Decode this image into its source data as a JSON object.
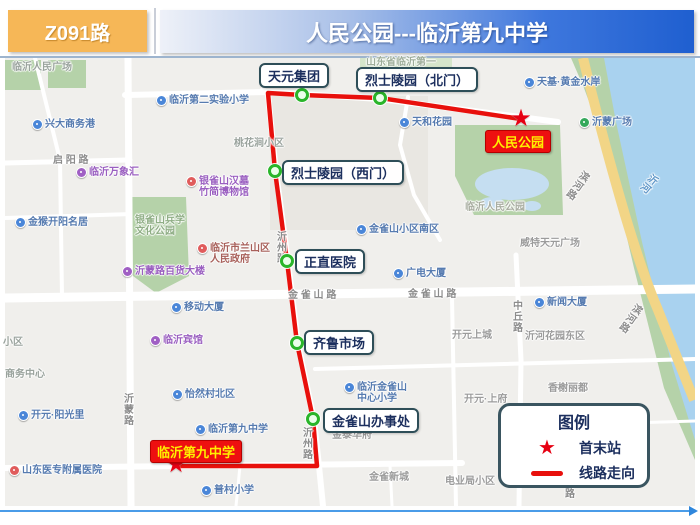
{
  "header": {
    "route_number": "Z091路",
    "route_title": "人民公园---临沂第九中学"
  },
  "legend": {
    "title": "图例",
    "items": [
      {
        "symbol": "star",
        "label": "首末站"
      },
      {
        "symbol": "route-line",
        "label": "线路走向"
      }
    ]
  },
  "route": {
    "color": "#e8100c",
    "path": "521,119 380,98 302,95 268,93 275,171 287,261 297,343 313,419 317,466 176,466",
    "terminals": [
      {
        "label": "人民公园",
        "box_x": 485,
        "box_y": 130,
        "star_x": 521,
        "star_y": 120
      },
      {
        "label": "临沂第九中学",
        "box_x": 150,
        "box_y": 440,
        "star_x": 176,
        "star_y": 466
      }
    ],
    "stops": [
      {
        "label": "天元集团",
        "box_x": 259,
        "box_y": 63,
        "dot_x": 302,
        "dot_y": 95
      },
      {
        "label": "烈士陵园（北门）",
        "box_x": 356,
        "box_y": 67,
        "dot_x": 380,
        "dot_y": 98
      },
      {
        "label": "烈士陵园（西门）",
        "box_x": 282,
        "box_y": 160,
        "dot_x": 275,
        "dot_y": 171
      },
      {
        "label": "正直医院",
        "box_x": 295,
        "box_y": 249,
        "dot_x": 287,
        "dot_y": 261
      },
      {
        "label": "齐鲁市场",
        "box_x": 304,
        "box_y": 330,
        "dot_x": 297,
        "dot_y": 343
      },
      {
        "label": "金雀山办事处",
        "box_x": 323,
        "box_y": 408,
        "dot_x": 313,
        "dot_y": 419
      }
    ]
  },
  "map": {
    "labels": [
      {
        "text": "临沂人民广场",
        "x": 12,
        "y": 62,
        "color": "#9aa39d"
      },
      {
        "pin": "#4a86d8",
        "text": "兴大商务港",
        "x": 32,
        "y": 119,
        "color": "#567bb0"
      },
      {
        "text": "启 阳 路",
        "x": 53,
        "y": 155,
        "color": "#8c8c8c"
      },
      {
        "pin": "#a05fc4",
        "text": "临沂万象汇",
        "x": 76,
        "y": 167,
        "color": "#9a5fc0"
      },
      {
        "pin": "#4a86d8",
        "text": "金猴开阳名居",
        "x": 15,
        "y": 217,
        "color": "#567bb0"
      },
      {
        "pin": "#e05c5c",
        "lines": [
          "银雀山汉墓",
          "竹简博物馆"
        ],
        "x": 186,
        "y": 176,
        "color": "#9a5fc0"
      },
      {
        "lines": [
          "银雀山兵学",
          "文化公园"
        ],
        "x": 135,
        "y": 215,
        "color": "#8fae85"
      },
      {
        "pin": "#e05c5c",
        "lines": [
          "临沂市兰山区",
          "人民政府"
        ],
        "x": 197,
        "y": 243,
        "color": "#a8605a"
      },
      {
        "pin": "#a05fc4",
        "text": "沂蒙路百货大楼",
        "x": 122,
        "y": 266,
        "color": "#9a5fc0"
      },
      {
        "pin": "#4a86d8",
        "text": "移动大厦",
        "x": 171,
        "y": 302,
        "color": "#567bb0"
      },
      {
        "pin": "#a05fc4",
        "text": "临沂宾馆",
        "x": 150,
        "y": 335,
        "color": "#9a5fc0"
      },
      {
        "text": "小区",
        "x": 3,
        "y": 337,
        "color": "#9aa39d"
      },
      {
        "text": "商务中心",
        "x": 5,
        "y": 369,
        "color": "#9aa39d"
      },
      {
        "pin": "#4a86d8",
        "text": "开元·阳光里",
        "x": 18,
        "y": 410,
        "color": "#567bb0"
      },
      {
        "text": "沂蒙路",
        "x": 124,
        "y": 394,
        "color": "#8c8c8c",
        "vertical": true
      },
      {
        "pin": "#e05c5c",
        "text": "山东医专附属医院",
        "x": 9,
        "y": 465,
        "color": "#567bb0"
      },
      {
        "pin": "#4a86d8",
        "text": "怡然村北区",
        "x": 172,
        "y": 389,
        "color": "#567bb0"
      },
      {
        "pin": "#4a86d8",
        "text": "临沂第九中学",
        "x": 195,
        "y": 424,
        "color": "#567bb0"
      },
      {
        "pin": "#4a86d8",
        "text": "普村小学",
        "x": 201,
        "y": 485,
        "color": "#567bb0"
      },
      {
        "pin": "#4a86d8",
        "text": "临沂第二实验小学",
        "x": 156,
        "y": 95,
        "color": "#567bb0"
      },
      {
        "text": "桃花涧小区",
        "x": 234,
        "y": 138,
        "color": "#9aa39d"
      },
      {
        "text": "山东省临沂第一",
        "x": 366,
        "y": 57,
        "color": "#9fae9a"
      },
      {
        "pin": "#4a86d8",
        "text": "天和花园",
        "x": 399,
        "y": 117,
        "color": "#567bb0"
      },
      {
        "pin": "#4a86d8",
        "text": "金雀山小区南区",
        "x": 356,
        "y": 224,
        "color": "#567bb0"
      },
      {
        "pin": "#4a86d8",
        "text": "广电大厦",
        "x": 393,
        "y": 268,
        "color": "#567bb0"
      },
      {
        "text": "金 雀 山 路",
        "x": 288,
        "y": 290,
        "color": "#8c8c8c"
      },
      {
        "text": "金 雀 山 路",
        "x": 408,
        "y": 289,
        "color": "#8c8c8c"
      },
      {
        "text": "沂州路",
        "x": 277,
        "y": 232,
        "color": "#8c8c8c",
        "vertical": true
      },
      {
        "text": "沂州路",
        "x": 303,
        "y": 428,
        "color": "#8c8c8c",
        "vertical": true
      },
      {
        "text": "开元上城",
        "x": 452,
        "y": 330,
        "color": "#9b9b9b"
      },
      {
        "text": "威特天元广场",
        "x": 520,
        "y": 238,
        "color": "#9b9b9b"
      },
      {
        "pin": "#4a86d8",
        "text": "新闻大厦",
        "x": 534,
        "y": 297,
        "color": "#567bb0"
      },
      {
        "text": "中丘路",
        "x": 513,
        "y": 301,
        "color": "#8c8c8c",
        "vertical": true
      },
      {
        "text": "沂河花园东区",
        "x": 525,
        "y": 331,
        "color": "#9b9b9b"
      },
      {
        "text": "香榭丽都",
        "x": 548,
        "y": 383,
        "color": "#9b9b9b"
      },
      {
        "text": "开元·上府",
        "x": 464,
        "y": 394,
        "color": "#9b9b9b"
      },
      {
        "text": "金泰华府",
        "x": 332,
        "y": 430,
        "color": "#9b9b9b"
      },
      {
        "pin": "#4a86d8",
        "lines": [
          "临沂金雀山",
          "中心小学"
        ],
        "x": 344,
        "y": 382,
        "color": "#567bb0"
      },
      {
        "text": "金雀新城",
        "x": 369,
        "y": 472,
        "color": "#9b9b9b"
      },
      {
        "text": "电业局小区",
        "x": 445,
        "y": 476,
        "color": "#9b9b9b"
      },
      {
        "pin": "#4a86d8",
        "text": "天基·黄金水岸",
        "x": 524,
        "y": 77,
        "color": "#567bb0"
      },
      {
        "pin": "#35a85b",
        "text": "沂蒙广场",
        "x": 579,
        "y": 117,
        "color": "#567bb0"
      },
      {
        "text": "临沂人民公园",
        "x": 465,
        "y": 202,
        "color": "#a8ada0"
      },
      {
        "text": "滨河路",
        "x": 583,
        "y": 170,
        "color": "#8c8c8c",
        "vertical": true,
        "rotate": 35
      },
      {
        "text": "沂河",
        "x": 652,
        "y": 173,
        "color": "#5e96c8",
        "vertical": true,
        "rotate": 40
      },
      {
        "text": "滨河路",
        "x": 636,
        "y": 303,
        "color": "#8c8c8c",
        "vertical": true,
        "rotate": 35
      },
      {
        "text": "路",
        "x": 565,
        "y": 489,
        "color": "#8c8c8c"
      }
    ]
  }
}
